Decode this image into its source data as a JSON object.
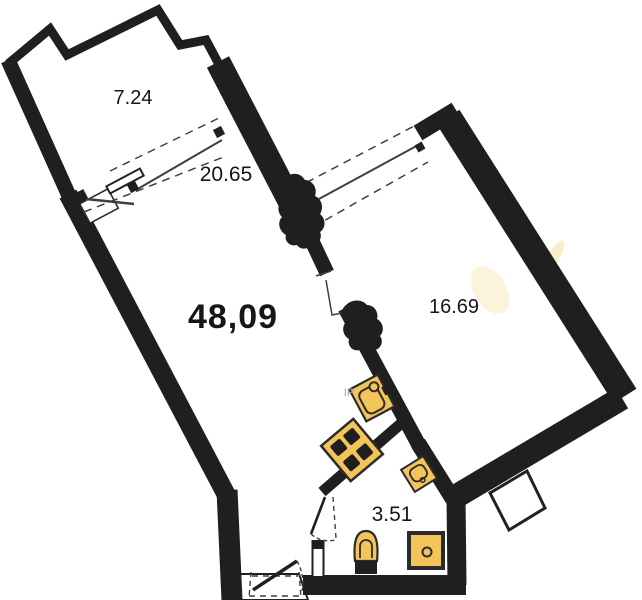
{
  "plan": {
    "type": "apartment-floor-plan",
    "background": "#ffffff",
    "wall_color": "#1f1f1f",
    "line_color": "#3f3f3f",
    "dash_color": "#4a4a4a",
    "fixture_fill": "#f3c45a",
    "fixture_stroke": "#2b2b2b",
    "label_color": "#161616",
    "rooms": [
      {
        "name": "balcony",
        "area": "7.24"
      },
      {
        "name": "living-room",
        "area": "20.65"
      },
      {
        "name": "apartment-total",
        "area": "48,09"
      },
      {
        "name": "bedroom",
        "area": "16.69"
      },
      {
        "name": "bathroom",
        "area": "3.51"
      }
    ],
    "faint_mark": "IP"
  }
}
